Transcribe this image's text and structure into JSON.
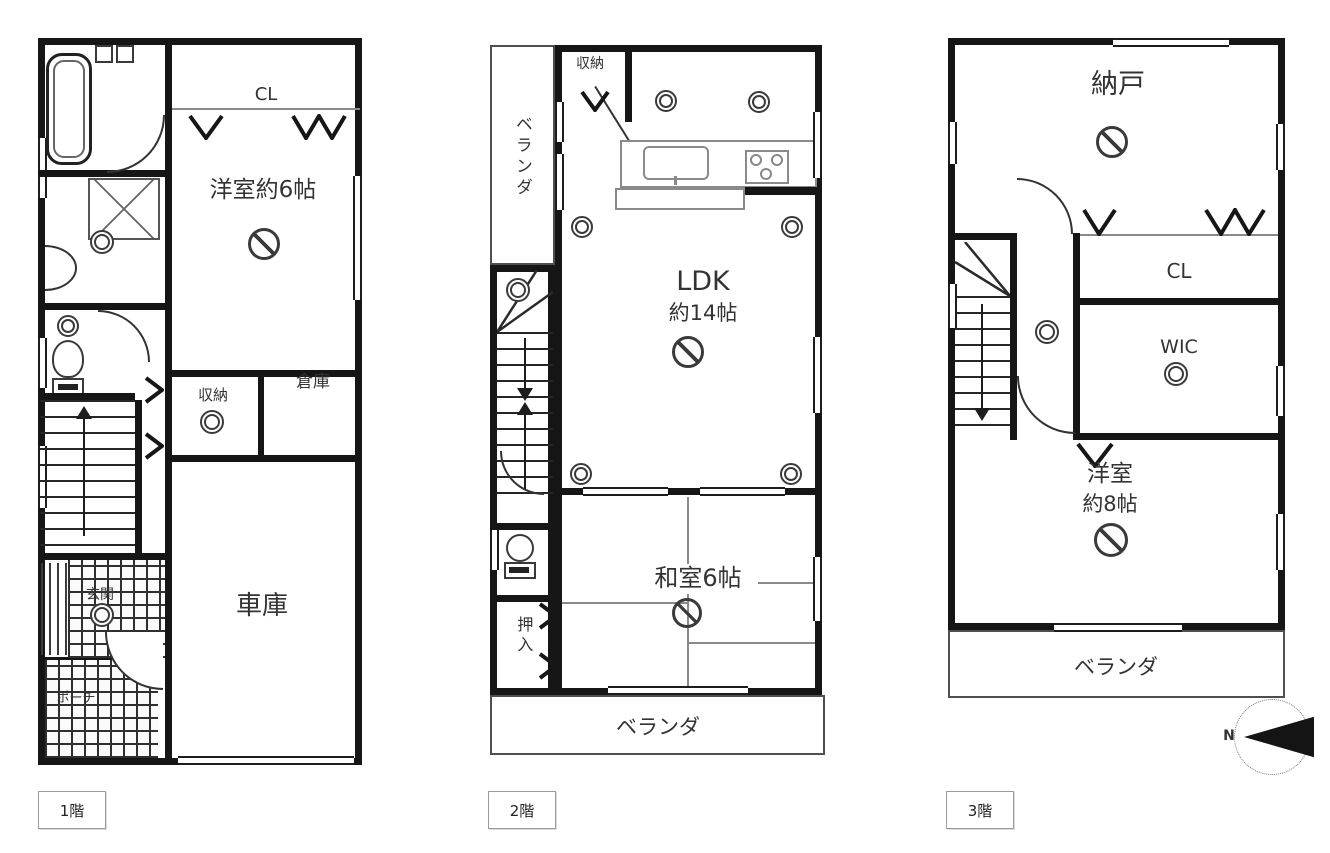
{
  "floors": [
    {
      "label": "1階",
      "rooms": {
        "cl": "CL",
        "western": "洋室約6帖",
        "shuno": "収納",
        "souko": "倉庫",
        "shako": "車庫",
        "genkan": "玄関",
        "porch": "ポーチ"
      }
    },
    {
      "label": "2階",
      "rooms": {
        "shuno": "収納",
        "veranda_left": "ベランダ",
        "ldk1": "LDK",
        "ldk2": "約14帖",
        "washitsu": "和室6帖",
        "oshiire": "押入",
        "veranda": "ベランダ"
      }
    },
    {
      "label": "3階",
      "rooms": {
        "nando": "納戸",
        "cl": "CL",
        "wic": "WIC",
        "western1": "洋室",
        "western2": "約8帖",
        "veranda": "ベランダ"
      }
    }
  ],
  "compass": {
    "north": "N"
  }
}
